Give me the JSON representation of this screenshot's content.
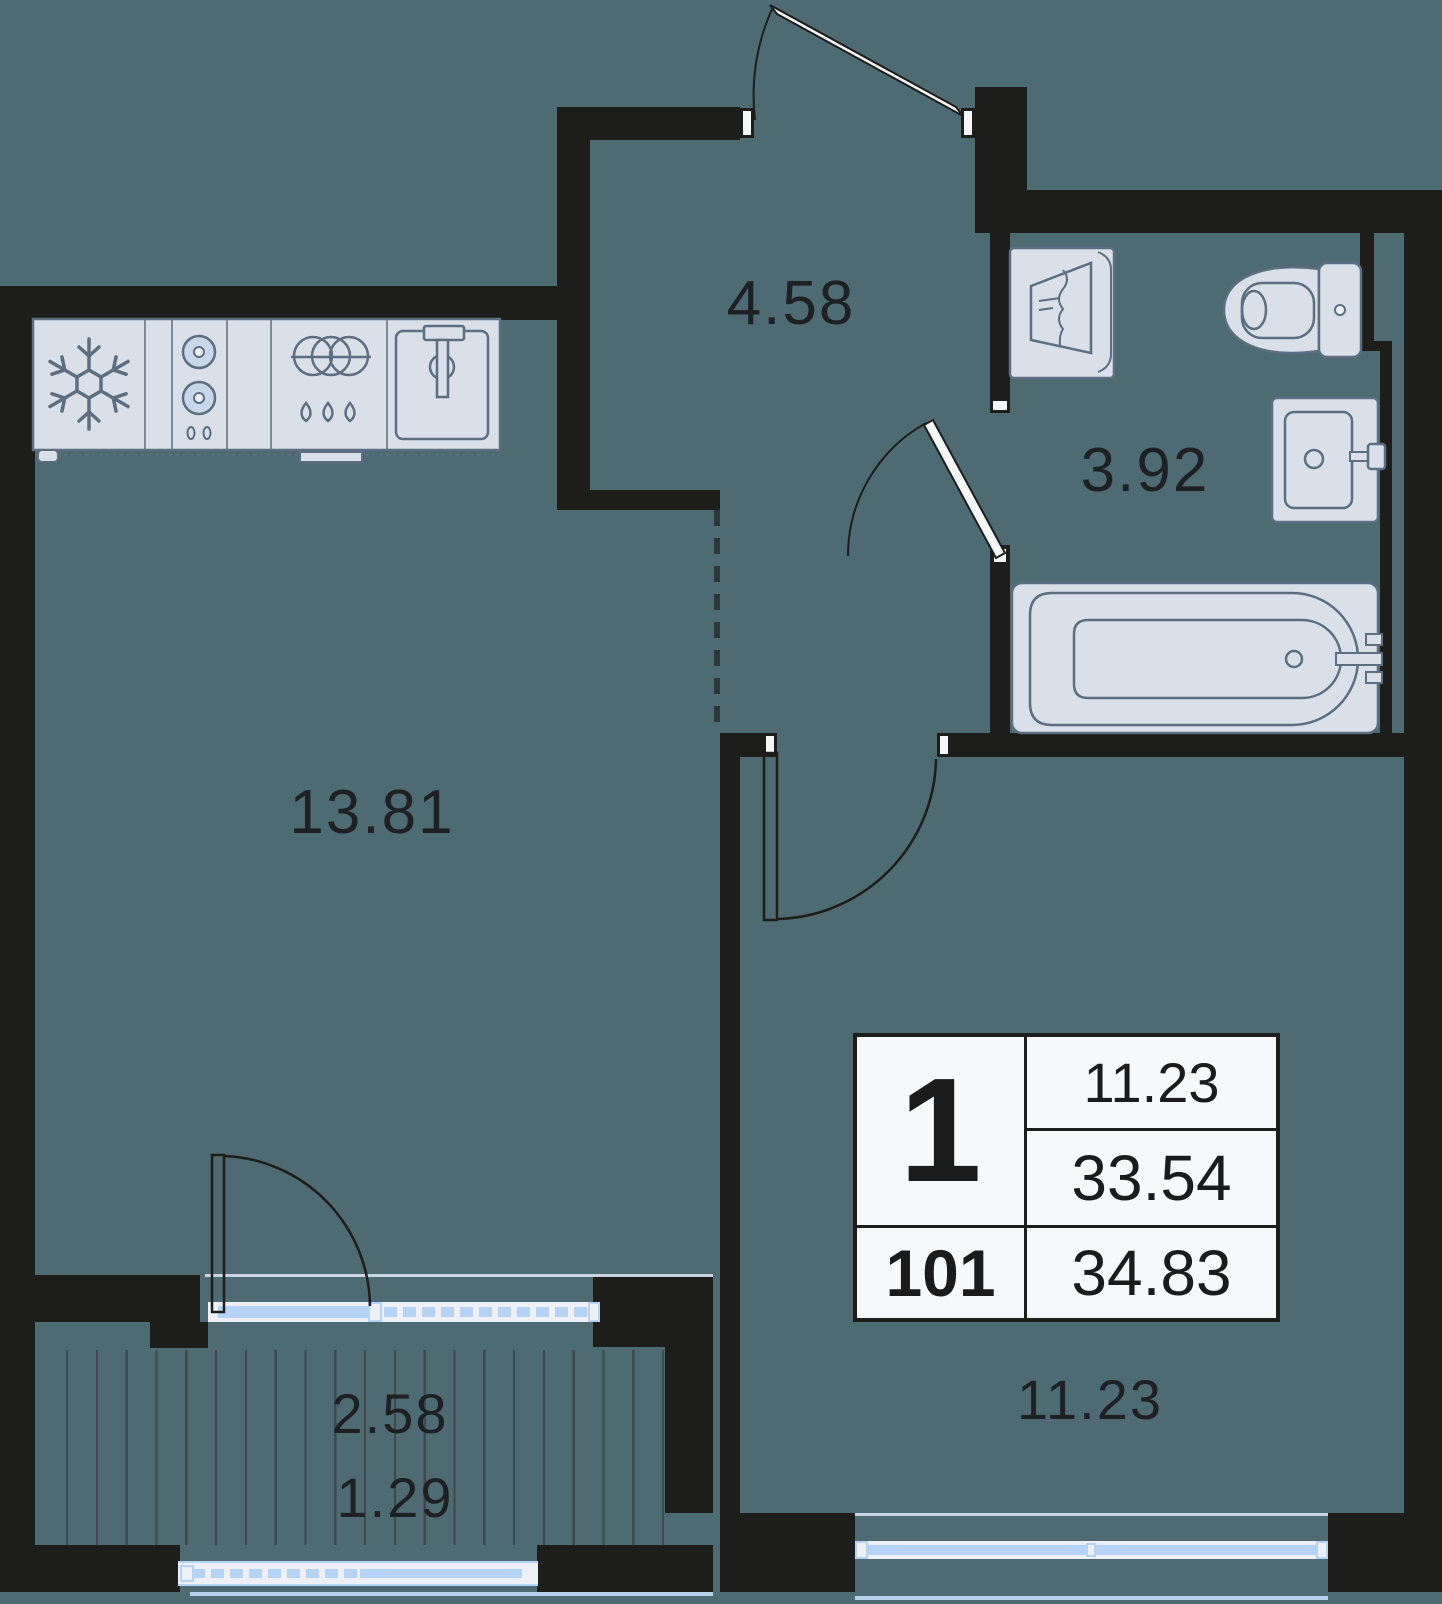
{
  "rooms": [
    {
      "id": "hallway",
      "area": "4.58"
    },
    {
      "id": "bathroom",
      "area": "3.92"
    },
    {
      "id": "kitchen-living-room",
      "area": "13.81"
    },
    {
      "id": "bedroom",
      "area": "11.23"
    },
    {
      "id": "balcony",
      "area_full": "2.58",
      "area_half": "1.29"
    }
  ],
  "info_table": {
    "room_count": "1",
    "unit_number": "101",
    "living_area": "11.23",
    "area_without_summer": "33.54",
    "total_area": "34.83"
  },
  "colors": {
    "background": "#4e6a72",
    "walls": "#1d1d1b",
    "fixture_fill": "#d9e0ea",
    "fixture_stroke": "#5d6e80",
    "window_blue": "#b5d3f4",
    "window_frame": "#edf1f7",
    "hatch_line": "#3e484d",
    "table_background": "#f7f8f9",
    "label_text": "#1d2125"
  },
  "icons": {
    "fridge": "snowflake-icon",
    "stove": "two-burner-icon",
    "dishwasher": "dishes-and-drops-icon",
    "kitchen_sink": "sink-basin-faucet-icon",
    "washing_machine": "washing-machine-icon",
    "toilet": "toilet-icon",
    "bathroom_sink": "washbasin-icon",
    "bathtub": "bathtub-icon"
  }
}
